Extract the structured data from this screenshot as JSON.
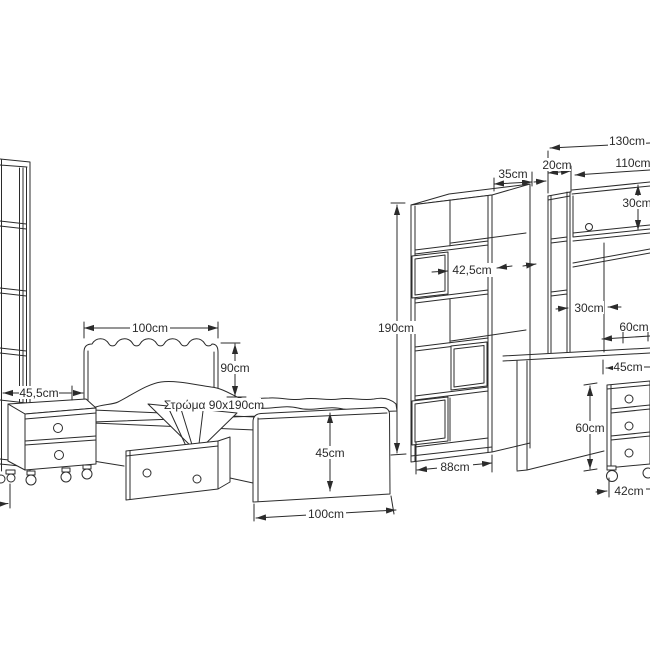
{
  "page": {
    "background": "#ffffff",
    "line_color": "#2b2b2b"
  },
  "furniture": {
    "left_shelf": {
      "width": "45,5cm"
    },
    "bed": {
      "headboard_width": "100cm",
      "headboard_height": "90cm",
      "mattress": "Στρώμα 90x190cm",
      "footboard_height": "45cm",
      "length": "100cm"
    },
    "bookcase": {
      "depth": "35cm",
      "inner_width": "42,5cm",
      "height": "190cm",
      "width": "88cm"
    },
    "desk": {
      "total_width": "130cm",
      "column_width": "20cm",
      "hutch_width": "110cm",
      "cabinet_height": "30cm",
      "niche_width": "30cm",
      "worktop_depth": "60cm"
    },
    "pedestal": {
      "width": "45cm",
      "height": "60cm",
      "base_width": "42cm"
    }
  }
}
